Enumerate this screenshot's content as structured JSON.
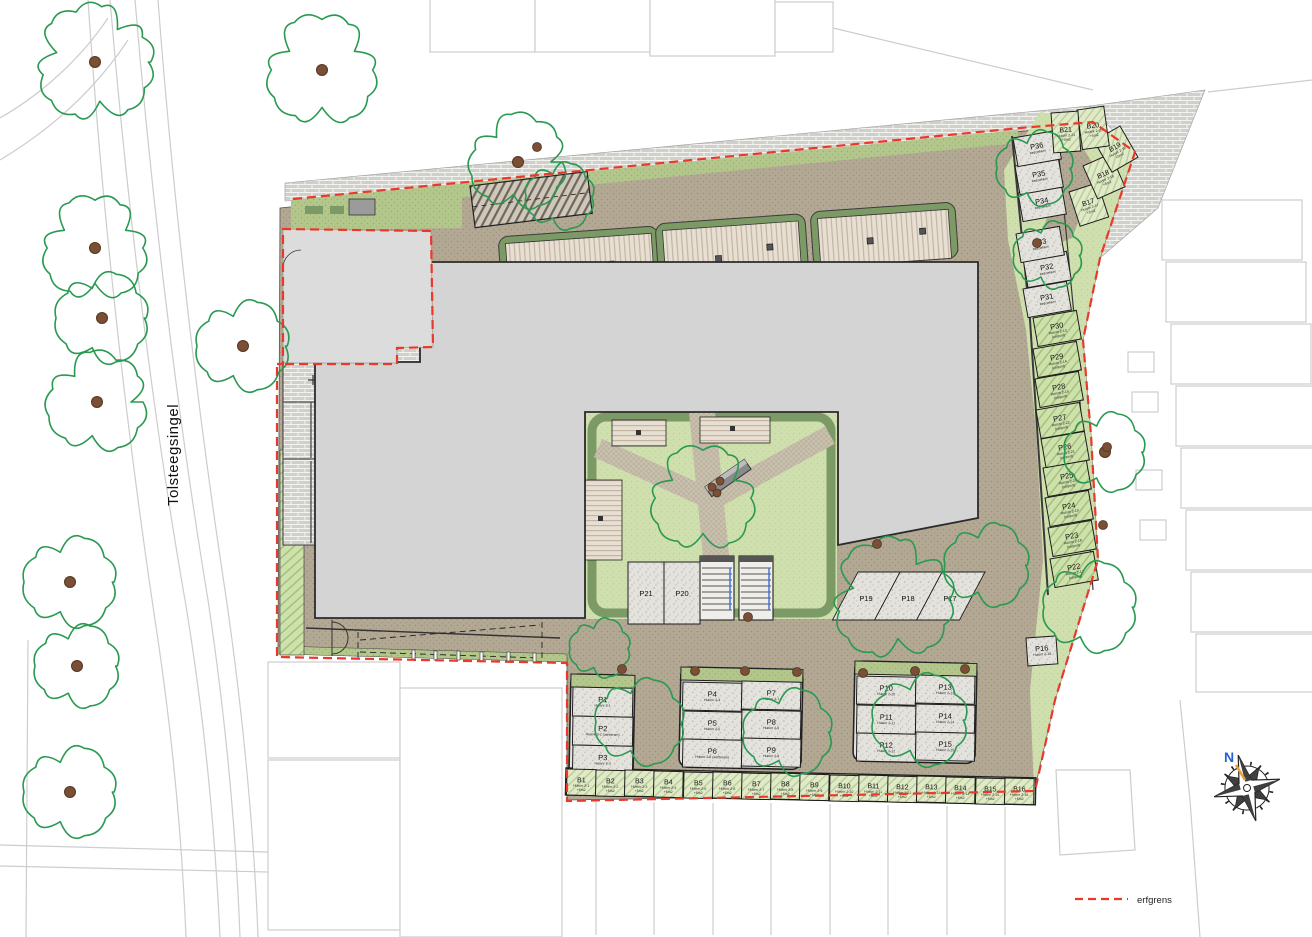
{
  "street": {
    "name": "Tolsteegsingel"
  },
  "compass": {
    "north_label": "N"
  },
  "legend": {
    "erfgrens_label": "erfgrens",
    "erfgrens_color": "#e8392a"
  },
  "colors": {
    "ground_taupe": "#b3a894",
    "lawn_green": "#cfdfad",
    "edge_green": "#7c9a66",
    "building_gray": "#d4d4d4",
    "tree_green": "#2a9a52",
    "trunk_brown": "#7b4f35",
    "erfgrens_red": "#e8392a"
  },
  "plan": {
    "parking_spots": [
      {
        "id": "P1",
        "x": 573,
        "y": 687,
        "w": 60,
        "h": 29,
        "rot": 1.2,
        "kind": "stipple",
        "sub": [
          "Huisnr 2-1"
        ]
      },
      {
        "id": "P2",
        "x": 573,
        "y": 716,
        "w": 60,
        "h": 29,
        "rot": 1.2,
        "kind": "stipple",
        "sub": [
          "Huisnr 2-2 (achterom)"
        ]
      },
      {
        "id": "P3",
        "x": 573,
        "y": 745,
        "w": 60,
        "h": 29,
        "rot": 1.2,
        "kind": "stipple",
        "sub": [
          "Huisnr 2-3"
        ]
      },
      {
        "id": "P4",
        "x": 683,
        "y": 682,
        "w": 59,
        "h": 28,
        "rot": 1.2,
        "kind": "stipple",
        "sub": [
          "Huisnr 2-4"
        ]
      },
      {
        "id": "P5",
        "x": 683,
        "y": 711,
        "w": 59,
        "h": 28,
        "rot": 1.2,
        "kind": "stipple",
        "sub": [
          "Huisnr 2-5"
        ]
      },
      {
        "id": "P6",
        "x": 683,
        "y": 739,
        "w": 59,
        "h": 28,
        "rot": 1.2,
        "kind": "stipple",
        "sub": [
          "Huisnr 2-6 (achterom)"
        ]
      },
      {
        "id": "P7",
        "x": 742,
        "y": 681,
        "w": 59,
        "h": 28,
        "rot": 1.2,
        "kind": "stipple",
        "sub": [
          "Huisnr 2-7"
        ]
      },
      {
        "id": "P8",
        "x": 742,
        "y": 710,
        "w": 59,
        "h": 28,
        "rot": 1.2,
        "kind": "stipple",
        "sub": [
          "Huisnr 2-8"
        ]
      },
      {
        "id": "P9",
        "x": 742,
        "y": 738,
        "w": 59,
        "h": 28,
        "rot": 1.2,
        "kind": "stipple",
        "sub": [
          "Huisnr 2-9"
        ]
      },
      {
        "id": "P10",
        "x": 857,
        "y": 676,
        "w": 59,
        "h": 28,
        "rot": 1.2,
        "kind": "stipple",
        "sub": [
          "Huisnr 2-10"
        ]
      },
      {
        "id": "P11",
        "x": 857,
        "y": 705,
        "w": 59,
        "h": 28,
        "rot": 1.2,
        "kind": "stipple",
        "sub": [
          "Huisnr 2-11"
        ]
      },
      {
        "id": "P12",
        "x": 857,
        "y": 733,
        "w": 59,
        "h": 28,
        "rot": 1.2,
        "kind": "stipple",
        "sub": [
          "Huisnr 2-12"
        ]
      },
      {
        "id": "P13",
        "x": 916,
        "y": 675,
        "w": 59,
        "h": 28,
        "rot": 1.2,
        "kind": "stipple",
        "sub": [
          "Huisnr 2-13"
        ]
      },
      {
        "id": "P14",
        "x": 916,
        "y": 704,
        "w": 59,
        "h": 28,
        "rot": 1.2,
        "kind": "stipple",
        "sub": [
          "Huisnr 2-14"
        ]
      },
      {
        "id": "P15",
        "x": 916,
        "y": 732,
        "w": 59,
        "h": 28,
        "rot": 1.2,
        "kind": "stipple",
        "sub": [
          "Huisnr 2-15"
        ]
      },
      {
        "id": "P16",
        "x": 1026,
        "y": 638,
        "w": 30,
        "h": 28,
        "rot": -4,
        "kind": "stipple",
        "sub": [
          "Huisnr 2-16"
        ]
      },
      {
        "id": "P17",
        "x": 942,
        "y": 572,
        "w": 43,
        "h": 48,
        "skew": -28,
        "lx": 950,
        "ly": 598,
        "kind": "stipple"
      },
      {
        "id": "P18",
        "x": 900,
        "y": 572,
        "w": 42,
        "h": 48,
        "skew": -28,
        "lx": 908,
        "ly": 598,
        "kind": "stipple"
      },
      {
        "id": "P19",
        "x": 858,
        "y": 572,
        "w": 42,
        "h": 48,
        "skew": -28,
        "lx": 866,
        "ly": 598,
        "kind": "stipple"
      },
      {
        "id": "P20",
        "x": 664,
        "y": 562,
        "w": 36,
        "h": 62,
        "rot": 0,
        "kind": "stipple"
      },
      {
        "id": "P21",
        "x": 628,
        "y": 562,
        "w": 36,
        "h": 62,
        "rot": 0,
        "kind": "stipple"
      },
      {
        "id": "P22",
        "x": 1050,
        "y": 559,
        "w": 44,
        "h": 29,
        "rot": -10,
        "kind": "carport",
        "sub": [
          "Huisnr 2-17",
          "(carport)"
        ]
      },
      {
        "id": "P23",
        "x": 1048,
        "y": 528,
        "w": 44,
        "h": 29,
        "rot": -10,
        "kind": "carport",
        "sub": [
          "Huisnr 2-18",
          "(carport)"
        ]
      },
      {
        "id": "P24",
        "x": 1045,
        "y": 498,
        "w": 44,
        "h": 29,
        "rot": -10,
        "kind": "carport",
        "sub": [
          "Huisnr 2-19",
          "(carport)"
        ]
      },
      {
        "id": "P25",
        "x": 1043,
        "y": 468,
        "w": 44,
        "h": 29,
        "rot": -10,
        "kind": "carport",
        "sub": [
          "Huisnr 2-20",
          "(carport)"
        ]
      },
      {
        "id": "P26",
        "x": 1041,
        "y": 439,
        "w": 44,
        "h": 29,
        "rot": -10,
        "kind": "carport",
        "sub": [
          "Huisnr 2-21",
          "(carport)"
        ]
      },
      {
        "id": "P27",
        "x": 1036,
        "y": 410,
        "w": 44,
        "h": 29,
        "rot": -10,
        "kind": "carport",
        "sub": [
          "Huisnr 2-22",
          "(carport)"
        ]
      },
      {
        "id": "P28",
        "x": 1035,
        "y": 379,
        "w": 44,
        "h": 29,
        "rot": -10,
        "kind": "carport",
        "sub": [
          "Huisnr 2-15",
          "(carport)"
        ]
      },
      {
        "id": "P29",
        "x": 1033,
        "y": 349,
        "w": 44,
        "h": 29,
        "rot": -10,
        "kind": "carport",
        "sub": [
          "Huisnr 2-14",
          "(carport)"
        ]
      },
      {
        "id": "P30",
        "x": 1033,
        "y": 318,
        "w": 44,
        "h": 29,
        "rot": -10,
        "kind": "carport",
        "sub": [
          "Huisnr 2-13",
          "(carport)"
        ]
      },
      {
        "id": "P31",
        "x": 1023,
        "y": 289,
        "w": 44,
        "h": 29,
        "rot": -10,
        "kind": "stipple",
        "sub": [
          "bezoekers"
        ]
      },
      {
        "id": "P32",
        "x": 1023,
        "y": 259,
        "w": 44,
        "h": 29,
        "rot": -10,
        "kind": "stipple",
        "sub": [
          "bezoekers"
        ]
      },
      {
        "id": "P33",
        "x": 1016,
        "y": 234,
        "w": 44,
        "h": 29,
        "rot": -10,
        "kind": "stipple",
        "sub": [
          "bezoekers"
        ]
      },
      {
        "id": "P34",
        "x": 1018,
        "y": 193,
        "w": 44,
        "h": 29,
        "rot": -10,
        "kind": "stipple",
        "sub": [
          "bezoekers"
        ]
      },
      {
        "id": "P35",
        "x": 1015,
        "y": 166,
        "w": 44,
        "h": 29,
        "rot": -10,
        "kind": "stipple",
        "sub": [
          "bezoekers"
        ]
      },
      {
        "id": "P36",
        "x": 1013,
        "y": 138,
        "w": 44,
        "h": 29,
        "rot": -10,
        "kind": "stipple",
        "sub": [
          "bezoekers"
        ]
      }
    ],
    "storage_units": [
      {
        "id": "B1",
        "x": 567,
        "y": 769,
        "w": 29.2,
        "h": 26,
        "rot": 1.2,
        "fs": 7,
        "kind": "storage",
        "sub": [
          "Huisnr 2-1",
          "+5m2"
        ]
      },
      {
        "id": "B2",
        "x": 596,
        "y": 770,
        "w": 29.2,
        "h": 26,
        "rot": 1.2,
        "fs": 7,
        "kind": "storage",
        "sub": [
          "Huisnr 2-2",
          "+5m2"
        ]
      },
      {
        "id": "B3",
        "x": 625,
        "y": 770,
        "w": 29.2,
        "h": 26,
        "rot": 1.2,
        "fs": 7,
        "kind": "storage",
        "sub": [
          "Huisnr 2-3",
          "+5m2"
        ]
      },
      {
        "id": "B4",
        "x": 654,
        "y": 771,
        "w": 29.2,
        "h": 26,
        "rot": 1.2,
        "fs": 7,
        "kind": "storage",
        "sub": [
          "Huisnr 2-4",
          "+5m2"
        ]
      },
      {
        "id": "B5",
        "x": 684,
        "y": 772,
        "w": 29.2,
        "h": 26,
        "rot": 1.2,
        "fs": 7,
        "kind": "storage",
        "sub": [
          "Huisnr 2-5",
          "+5m2"
        ]
      },
      {
        "id": "B6",
        "x": 713,
        "y": 772,
        "w": 29.2,
        "h": 26,
        "rot": 1.2,
        "fs": 7,
        "kind": "storage",
        "sub": [
          "Huisnr 2-6",
          "+5m2"
        ]
      },
      {
        "id": "B7",
        "x": 742,
        "y": 773,
        "w": 29.2,
        "h": 26,
        "rot": 1.2,
        "fs": 7,
        "kind": "storage",
        "sub": [
          "Huisnr 2-7",
          "+5m2"
        ]
      },
      {
        "id": "B8",
        "x": 771,
        "y": 773,
        "w": 29.2,
        "h": 26,
        "rot": 1.2,
        "fs": 7,
        "kind": "storage",
        "sub": [
          "Huisnr 2-8",
          "+5m2"
        ]
      },
      {
        "id": "B9",
        "x": 800,
        "y": 774,
        "w": 29.2,
        "h": 26,
        "rot": 1.2,
        "fs": 7,
        "kind": "storage",
        "sub": [
          "Huisnr 2-9",
          "+5m2"
        ]
      },
      {
        "id": "B10",
        "x": 830,
        "y": 775,
        "w": 29.2,
        "h": 26,
        "rot": 1.2,
        "fs": 7,
        "kind": "storage",
        "sub": [
          "Huisnr 2-10",
          "+5m2"
        ]
      },
      {
        "id": "B11",
        "x": 859,
        "y": 775,
        "w": 29.2,
        "h": 26,
        "rot": 1.2,
        "fs": 7,
        "kind": "storage",
        "sub": [
          "Huisnr 2-11",
          "+5m2"
        ]
      },
      {
        "id": "B12",
        "x": 888,
        "y": 776,
        "w": 29.2,
        "h": 26,
        "rot": 1.2,
        "fs": 7,
        "kind": "storage",
        "sub": [
          "Huisnr 2-12",
          "+5m2"
        ]
      },
      {
        "id": "B13",
        "x": 917,
        "y": 776,
        "w": 29.2,
        "h": 26,
        "rot": 1.2,
        "fs": 7,
        "kind": "storage",
        "sub": [
          "Huisnr 2-13",
          "+5m2"
        ]
      },
      {
        "id": "B14",
        "x": 946,
        "y": 777,
        "w": 29.2,
        "h": 26,
        "rot": 1.2,
        "fs": 7,
        "kind": "storage",
        "sub": [
          "Huisnr 2-14",
          "+5m2"
        ]
      },
      {
        "id": "B15",
        "x": 976,
        "y": 778,
        "w": 29.2,
        "h": 26,
        "rot": 1.2,
        "fs": 7,
        "kind": "storage",
        "sub": [
          "Huisnr 2-15",
          "+5m2"
        ]
      },
      {
        "id": "B16",
        "x": 1005,
        "y": 778,
        "w": 29.2,
        "h": 26,
        "rot": 1.2,
        "fs": 7,
        "kind": "storage",
        "sub": [
          "Huisnr 2-16",
          "+5m2"
        ]
      },
      {
        "id": "B17",
        "x": 1069,
        "y": 192,
        "w": 30,
        "h": 36,
        "rot": -18,
        "fs": 7,
        "kind": "storage",
        "sub": [
          "Huisnr 2-17",
          "+5m2"
        ]
      },
      {
        "id": "B18",
        "x": 1083,
        "y": 166,
        "w": 30,
        "h": 36,
        "rot": -24,
        "fs": 7,
        "kind": "storage",
        "sub": [
          "Huisnr 2-18",
          "+5m2"
        ]
      },
      {
        "id": "B19",
        "x": 1094,
        "y": 141,
        "w": 30,
        "h": 36,
        "rot": -30,
        "fs": 7,
        "kind": "storage",
        "sub": [
          "Huisnr 2-19",
          "+5m2"
        ]
      },
      {
        "id": "B20",
        "x": 1077,
        "y": 110,
        "w": 27,
        "h": 40,
        "rot": -8,
        "fs": 7,
        "kind": "storage",
        "sub": [
          "Huisnr 2-20",
          "+5m2"
        ]
      },
      {
        "id": "B21",
        "x": 1051,
        "y": 113,
        "w": 27,
        "h": 40,
        "rot": -4,
        "fs": 7,
        "kind": "storage",
        "sub": [
          "Huisnr 2-21",
          "+5m2"
        ]
      }
    ],
    "trees": [
      {
        "x": 95,
        "y": 62,
        "r": 58,
        "trunk": true
      },
      {
        "x": 322,
        "y": 70,
        "r": 55,
        "trunk": true
      },
      {
        "x": 95,
        "y": 248,
        "r": 52,
        "trunk": true
      },
      {
        "x": 102,
        "y": 318,
        "r": 46,
        "trunk": true
      },
      {
        "x": 97,
        "y": 402,
        "r": 50,
        "trunk": true
      },
      {
        "x": 243,
        "y": 346,
        "r": 46,
        "trunk": true
      },
      {
        "x": 70,
        "y": 582,
        "r": 46,
        "trunk": true
      },
      {
        "x": 77,
        "y": 666,
        "r": 42,
        "trunk": true
      },
      {
        "x": 70,
        "y": 792,
        "r": 46,
        "trunk": true
      },
      {
        "x": 518,
        "y": 162,
        "r": 48,
        "trunk": true
      },
      {
        "x": 560,
        "y": 196,
        "r": 34,
        "trunk": false
      },
      {
        "x": 703,
        "y": 498,
        "r": 52,
        "trunk": false
      },
      {
        "x": 893,
        "y": 598,
        "r": 60,
        "trunk": false
      },
      {
        "x": 987,
        "y": 565,
        "r": 42,
        "trunk": false
      },
      {
        "x": 1105,
        "y": 452,
        "r": 40,
        "trunk": true
      },
      {
        "x": 1090,
        "y": 607,
        "r": 46,
        "trunk": false
      },
      {
        "x": 1048,
        "y": 255,
        "r": 34,
        "trunk": false
      },
      {
        "x": 640,
        "y": 722,
        "r": 44,
        "trunk": false
      },
      {
        "x": 788,
        "y": 732,
        "r": 44,
        "trunk": false
      },
      {
        "x": 920,
        "y": 720,
        "r": 47,
        "trunk": false
      },
      {
        "x": 1035,
        "y": 168,
        "r": 38,
        "trunk": false
      },
      {
        "x": 600,
        "y": 648,
        "r": 30,
        "trunk": false
      }
    ],
    "shrub_dots": [
      {
        "x": 537,
        "y": 147
      },
      {
        "x": 1037,
        "y": 243
      },
      {
        "x": 712,
        "y": 487,
        "r": 4
      },
      {
        "x": 720,
        "y": 481,
        "r": 4
      },
      {
        "x": 717,
        "y": 493,
        "r": 4
      },
      {
        "x": 1107,
        "y": 447
      },
      {
        "x": 1103,
        "y": 525
      },
      {
        "x": 877,
        "y": 544
      },
      {
        "x": 748,
        "y": 617
      },
      {
        "x": 622,
        "y": 669
      },
      {
        "x": 695,
        "y": 671
      },
      {
        "x": 745,
        "y": 671
      },
      {
        "x": 797,
        "y": 672
      },
      {
        "x": 863,
        "y": 673
      },
      {
        "x": 915,
        "y": 671
      },
      {
        "x": 965,
        "y": 669
      }
    ]
  }
}
